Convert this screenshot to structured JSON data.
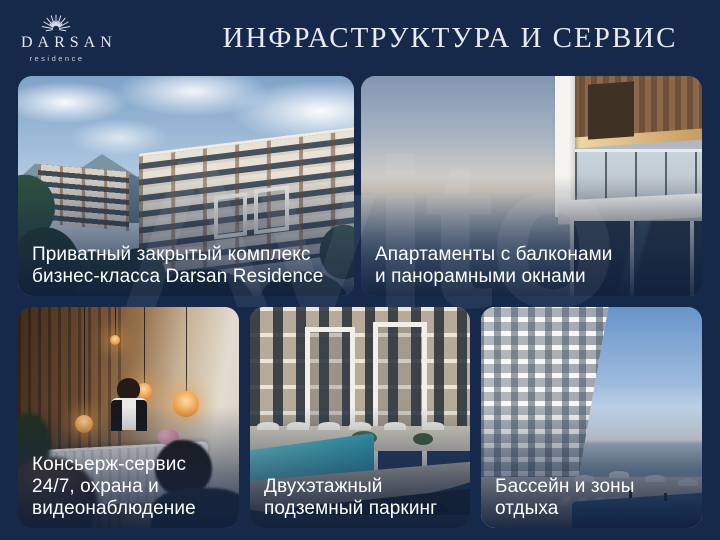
{
  "slide": {
    "background_color": "#17294b",
    "title_color": "#e8eaef"
  },
  "logo": {
    "brand": "DARSAN",
    "subtitle": "residence"
  },
  "title": "ИНФРАСТРУКТУРА И СЕРВИС",
  "watermark": "Avito",
  "cards": [
    {
      "name": "private-complex",
      "photo": "residential-complex-in-green-mountains",
      "caption": "Приватный закрытый комплекс\nбизнес-класса Darsan Residence"
    },
    {
      "name": "apartments-balconies",
      "photo": "balcony-with-glass-railing-over-hazy-sea",
      "caption": "Апартаменты с балконами\nи панорамными окнами"
    },
    {
      "name": "concierge-service",
      "photo": "reception-lobby-with-edison-bulbs",
      "caption": "Консьерж-сервис\n24/7, охрана и\nвидеонаблюдение"
    },
    {
      "name": "underground-parking",
      "photo": "pool-terrace-above-parking-entrance",
      "caption": "Двухэтажный\nподземный паркинг"
    },
    {
      "name": "pool-recreation",
      "photo": "tower-with-pool-deck-and-sea-view",
      "caption": "Бассейн и зоны\nотдыха"
    }
  ]
}
